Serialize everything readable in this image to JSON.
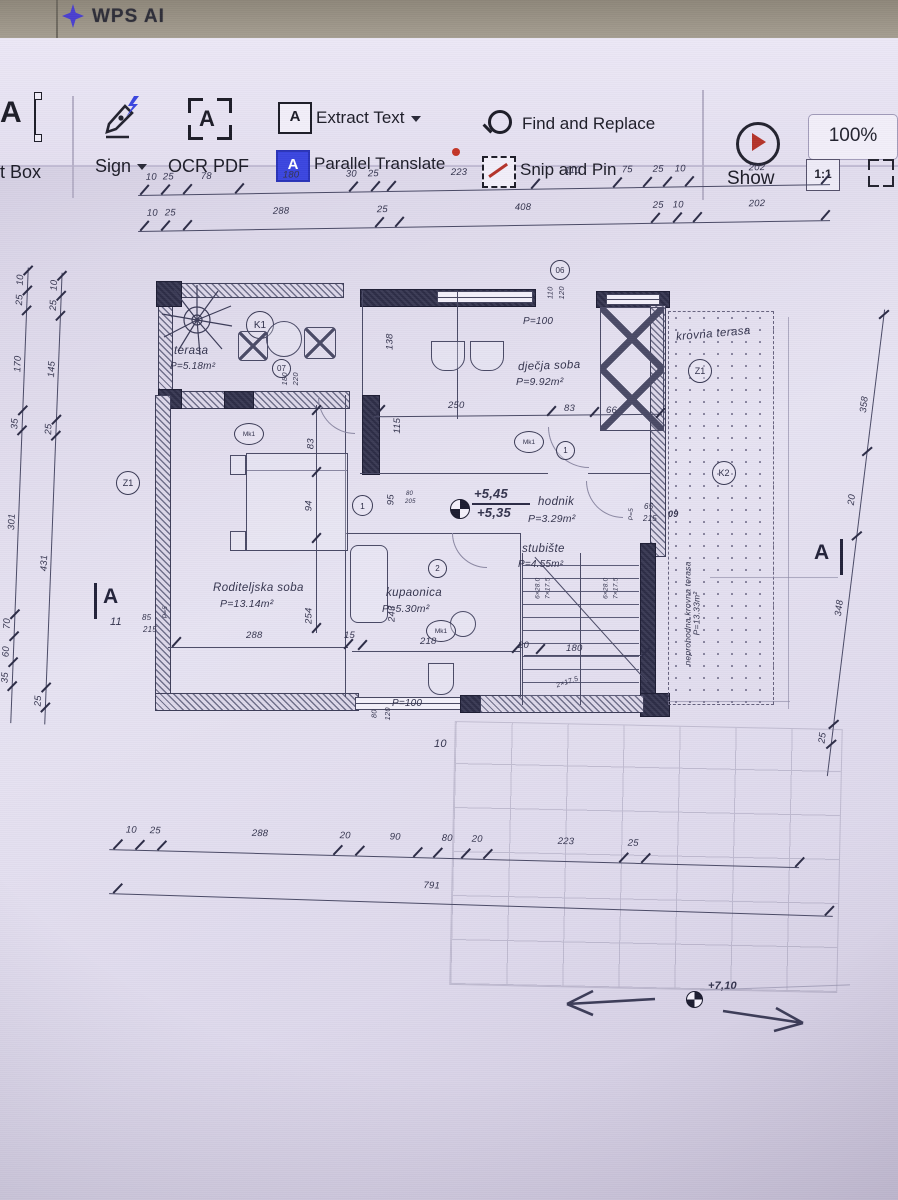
{
  "header": {
    "brand": "WPS AI"
  },
  "toolbar": {
    "textbox_label": "t Box",
    "sign_label": "Sign",
    "ocr_label": "OCR PDF",
    "extract_label": "Extract Text",
    "parallel_label": "Parallel Translate",
    "find_label": "Find and Replace",
    "snip_label": "Snip and Pin",
    "show_label": "Show",
    "zoom_value": "100%",
    "ratio_label": "1:1",
    "icons": {
      "textbox_glyph": "A",
      "ocr_glyph": "A",
      "extract_glyph": "A",
      "parallel_glyph": "A"
    }
  },
  "plan": {
    "rooms": {
      "terasa": {
        "name": "terasa",
        "area": "P=5.18m²"
      },
      "djecja": {
        "name": "dječja soba",
        "area": "P=9.92m²"
      },
      "krovna": {
        "name": "krovna terasa"
      },
      "hodnik": {
        "name": "hodnik",
        "area": "P=3.29m²"
      },
      "stubiste": {
        "name": "stubište",
        "area": "P=4.55m²"
      },
      "roditeljska": {
        "name": "Roditeljska soba",
        "area": "P=13.14m²"
      },
      "kupaonica": {
        "name": "kupaonica",
        "area": "P=5.30m²"
      },
      "neprohodna": {
        "name": "neprohodna krovna terasa",
        "area": "P=13.33m²"
      }
    },
    "markers": {
      "k1": "K1",
      "k2": "K2",
      "z1": "Z1",
      "mk1": "Mk1",
      "a": "A",
      "n06": "06",
      "n07": "07",
      "n1": "1",
      "n2": "2",
      "n11": "11",
      "n09": "09",
      "n10": "10"
    },
    "levels": {
      "up545": "+5,45",
      "up535": "+5,35",
      "up710": "+7,10"
    },
    "openings": {
      "p100a": "P=100",
      "p100b": "P=100",
      "p5a": "P=5",
      "p5b": "P=5",
      "w110": "110",
      "w120a": "120",
      "w180": "180",
      "w220": "220",
      "w80": "80",
      "w120b": "120",
      "d85": "85",
      "d215a": "215",
      "d65": "65",
      "d215b": "215"
    },
    "stairs": {
      "run1": "6×28.0",
      "rise1": "7×17.5",
      "run2": "6×28.0",
      "rise2": "7×17.5",
      "winder": "2×17.5"
    },
    "dims": {
      "top1": [
        "10",
        "25",
        "78",
        "180",
        "30",
        "25",
        "223",
        "110",
        "75",
        "25",
        "10",
        "202"
      ],
      "top2": [
        "10",
        "25",
        "288",
        "25",
        "408",
        "25",
        "10",
        "202"
      ],
      "left1": [
        "10",
        "25",
        "170",
        "35",
        "301",
        "70",
        "60",
        "35"
      ],
      "left2": [
        "10",
        "25",
        "145",
        "25",
        "431",
        "25"
      ],
      "right": [
        "358",
        "20",
        "348",
        "25"
      ],
      "bottom1": [
        "10",
        "25",
        "288",
        "20",
        "90",
        "80",
        "20",
        "223",
        "25"
      ],
      "bottom_total": "791",
      "inner": {
        "i250": "250",
        "i83a": "83",
        "i66": "66",
        "i138": "138",
        "i115": "115",
        "i83b": "83",
        "i94": "94",
        "i254": "254",
        "i95": "95",
        "i80": "80",
        "i205": "205",
        "i243": "243",
        "i218": "218",
        "i15": "15",
        "i20": "20",
        "i180": "180",
        "i288": "288"
      }
    }
  }
}
